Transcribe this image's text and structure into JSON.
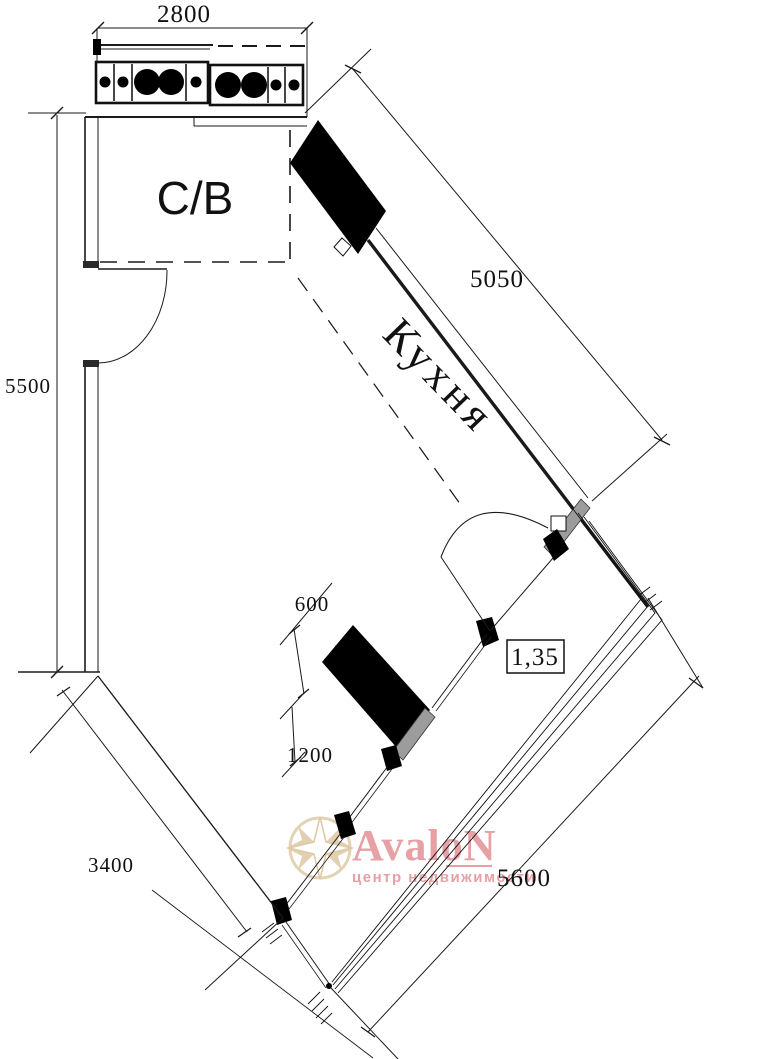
{
  "plan": {
    "rooms": {
      "bathroom_label": "С/В",
      "kitchen_label": "Кухня"
    },
    "dimensions": {
      "top_width": "2800",
      "left_height": "5500",
      "kitchen_wall": "5050",
      "pylon_width": "600",
      "pylon_length": "1200",
      "facade_left": "3400",
      "balcony": "5600",
      "entry_width": "1,35"
    },
    "watermark": {
      "brand": "AvaloN",
      "tagline": "центр недвижимости"
    },
    "colors": {
      "line": "#1a1a1a",
      "wall_fill": "#000000",
      "window_fill": "#9c9c9c",
      "brand_pink": "#e2898e",
      "compass_tan": "#d7bd92",
      "background": "#ffffff"
    }
  }
}
